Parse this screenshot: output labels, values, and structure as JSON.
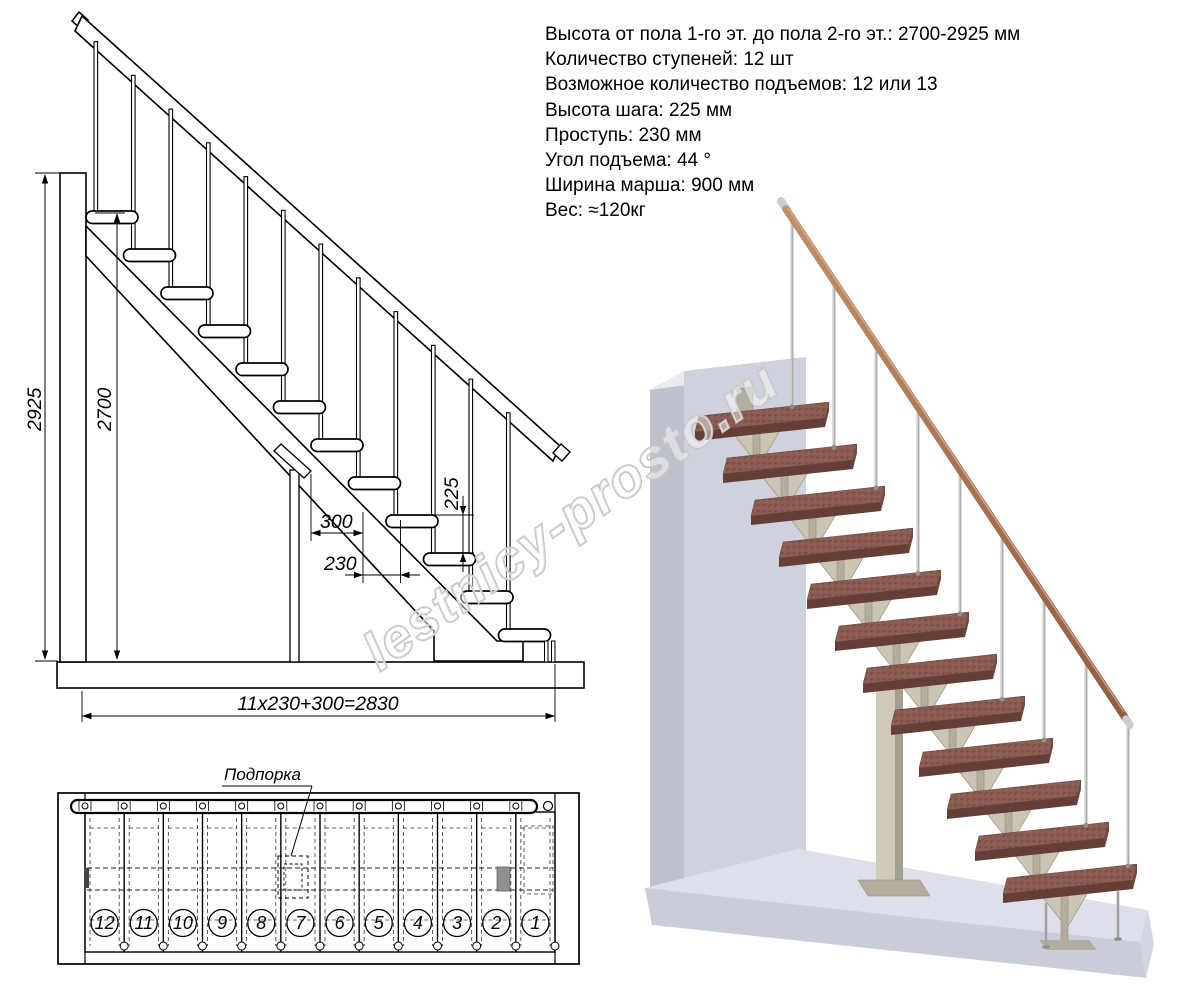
{
  "specs": {
    "lines": [
      "Высота от пола 1-го эт. до пола 2-го эт.: 2700-2925 мм",
      "Количество ступеней: 12 шт",
      "Возможное количество подъемов: 12 или 13",
      "Высота шага: 225 мм",
      "Проступь: 230 мм",
      "Угол подъема: 44 °",
      "Ширина марша: 900 мм",
      "Вес: ≈120кг"
    ]
  },
  "elevation": {
    "dim_total_height": "2925",
    "dim_floor_height": "2700",
    "dim_tread_length": "300",
    "dim_going": "230",
    "dim_rise": "225",
    "dim_total_run": "11x230+300=2830",
    "steps_count": 12
  },
  "plan": {
    "support_label": "Подпорка",
    "step_numbers": [
      "12",
      "11",
      "10",
      "9",
      "8",
      "7",
      "6",
      "5",
      "4",
      "3",
      "2",
      "1"
    ]
  },
  "watermark": {
    "text": "lestnicy-prosto.ru"
  },
  "render3d": {
    "colors": {
      "tread_top": "#8a5c52",
      "tread_front": "#653e37",
      "tread_side": "#74483f",
      "rail_light": "#c0906a",
      "rail_dark": "#8f5e42",
      "baluster": "#b0afaa",
      "bracket": "#b3ad9d",
      "bracket_fan": "#cbc5b4",
      "wall_front": "#ced2dc",
      "wall_side": "#bfc2cd",
      "wall_top": "#e9ebf1",
      "floor_top": "#dde0eb",
      "floor_front": "#c9cdda"
    }
  }
}
